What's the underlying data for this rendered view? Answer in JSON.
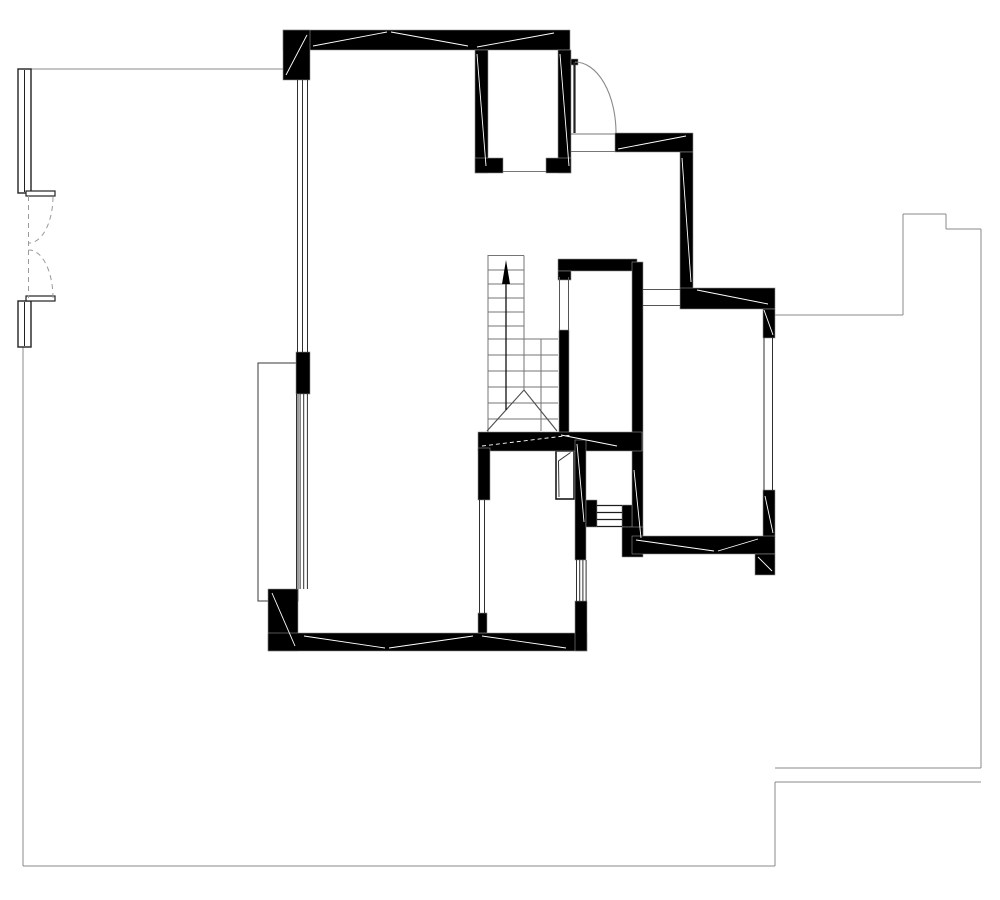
{
  "document": {
    "title": "architectural-floor-plan",
    "background": "#ffffff",
    "canvas": {
      "width": 1000,
      "height": 900
    }
  },
  "palette": {
    "wall": "#000000",
    "wall_halo": "#8f8f8f",
    "window_line": "#2f2f2f",
    "boundary": "#8a8a8a",
    "stair": "#757575",
    "break_line": "#4f4f4f",
    "arc": "#8a8a8a",
    "dash": "#9a9a9a",
    "hairline": "#ffffff",
    "arrow": "#000000"
  },
  "plan": {
    "walls": [
      {
        "name": "top-wall",
        "x": 283,
        "y": 30,
        "w": 287,
        "h": 20
      },
      {
        "name": "top-left-corner-pier",
        "x": 283,
        "y": 30,
        "w": 27,
        "h": 50
      },
      {
        "name": "left-wall-pier",
        "x": 296,
        "y": 352,
        "w": 14,
        "h": 42
      },
      {
        "name": "bottom-left-corner-pier",
        "x": 268,
        "y": 589,
        "w": 30,
        "h": 62
      },
      {
        "name": "bottom-wall",
        "x": 268,
        "y": 633,
        "w": 319,
        "h": 18
      },
      {
        "name": "shaft-left-wall",
        "x": 475,
        "y": 50,
        "w": 13,
        "h": 123
      },
      {
        "name": "shaft-right-wall",
        "x": 558,
        "y": 50,
        "w": 13,
        "h": 123
      },
      {
        "name": "shaft-bottom-wall-left",
        "x": 475,
        "y": 158,
        "w": 28,
        "h": 15
      },
      {
        "name": "shaft-bottom-wall-right",
        "x": 546,
        "y": 158,
        "w": 25,
        "h": 15
      },
      {
        "name": "entry-door-hinge-block",
        "x": 571,
        "y": 59,
        "w": 7,
        "h": 6
      },
      {
        "name": "entry-lintel-wall",
        "x": 615,
        "y": 133,
        "w": 78,
        "h": 19
      },
      {
        "name": "entry-side-wall",
        "x": 680,
        "y": 152,
        "w": 13,
        "h": 138
      },
      {
        "name": "hall-top-wall",
        "x": 558,
        "y": 259,
        "w": 79,
        "h": 12
      },
      {
        "name": "hall-top-wall-stub",
        "x": 558,
        "y": 271,
        "w": 13,
        "h": 9
      },
      {
        "name": "right-room-top-wall",
        "x": 680,
        "y": 288,
        "w": 95,
        "h": 21
      },
      {
        "name": "right-room-left-wall",
        "x": 632,
        "y": 262,
        "w": 11,
        "h": 292
      },
      {
        "name": "stair-side-wall",
        "x": 559,
        "y": 330,
        "w": 10,
        "h": 103
      },
      {
        "name": "understair-wall",
        "x": 478,
        "y": 432,
        "w": 164,
        "h": 19
      },
      {
        "name": "bath-right-wall",
        "x": 575,
        "y": 440,
        "w": 11,
        "h": 120
      },
      {
        "name": "bath-right-bottom-pier",
        "x": 575,
        "y": 601,
        "w": 12,
        "h": 50
      },
      {
        "name": "bath-left-wall",
        "x": 478,
        "y": 448,
        "w": 12,
        "h": 52
      },
      {
        "name": "bath-left-wall-stub",
        "x": 478,
        "y": 613,
        "w": 9,
        "h": 20
      },
      {
        "name": "louver-left-jamb",
        "x": 586,
        "y": 500,
        "w": 11,
        "h": 27
      },
      {
        "name": "louver-right-jamb",
        "x": 622,
        "y": 505,
        "w": 10,
        "h": 22
      },
      {
        "name": "right-room-corner-block",
        "x": 622,
        "y": 527,
        "w": 21,
        "h": 30
      },
      {
        "name": "right-room-right-wall-top",
        "x": 763,
        "y": 309,
        "w": 12,
        "h": 29
      },
      {
        "name": "right-room-right-wall-bottom",
        "x": 763,
        "y": 490,
        "w": 12,
        "h": 47
      },
      {
        "name": "right-room-bottom-wall",
        "x": 632,
        "y": 536,
        "w": 143,
        "h": 18
      },
      {
        "name": "right-room-bottom-stub",
        "x": 755,
        "y": 554,
        "w": 20,
        "h": 21
      }
    ],
    "boundary_lines": [
      [
        31,
        69,
        283,
        69
      ],
      [
        23,
        347,
        23,
        866
      ],
      [
        23,
        866,
        775,
        866
      ],
      [
        775,
        866,
        775,
        782
      ],
      [
        775,
        782,
        981,
        782
      ],
      [
        775,
        768,
        981,
        768
      ],
      [
        981,
        768,
        981,
        229
      ],
      [
        981,
        229,
        946,
        229
      ],
      [
        946,
        229,
        946,
        214
      ],
      [
        946,
        214,
        903,
        214
      ],
      [
        903,
        214,
        903,
        315
      ],
      [
        903,
        315,
        775,
        315
      ]
    ],
    "rects": [
      {
        "name": "planter-outline",
        "x": 258,
        "y": 363,
        "w": 40,
        "h": 238,
        "stroke": "#4a4a4a",
        "fill": "none",
        "sw": 1.1
      },
      {
        "name": "left-window-upper-box",
        "x": 18,
        "y": 69,
        "w": 13,
        "h": 124,
        "stroke": "#222222",
        "fill": "#ffffff",
        "sw": 1.4
      },
      {
        "name": "left-window-lower-box",
        "x": 18,
        "y": 301,
        "w": 13,
        "h": 46,
        "stroke": "#222222",
        "fill": "#ffffff",
        "sw": 1.4
      },
      {
        "name": "left-door-jamb-tick-upper",
        "x": 26,
        "y": 191,
        "w": 29,
        "h": 5,
        "stroke": "#222222",
        "fill": "#ffffff",
        "sw": 1.2
      },
      {
        "name": "left-door-jamb-tick-lower",
        "x": 26,
        "y": 296,
        "w": 29,
        "h": 5,
        "stroke": "#222222",
        "fill": "#ffffff",
        "sw": 1.2
      },
      {
        "name": "bath-door-frame",
        "x": 556,
        "y": 451,
        "w": 18,
        "h": 48,
        "stroke": "#1a1a1a",
        "fill": "#ffffff",
        "sw": 1.6
      }
    ],
    "line_groups": [
      {
        "name": "left-window-upper-mullion",
        "color": "#222222",
        "width": 1,
        "lines": [
          [
            24.5,
            70,
            24.5,
            192
          ]
        ]
      },
      {
        "name": "left-window-lower-mullion",
        "color": "#222222",
        "width": 1,
        "lines": [
          [
            24.5,
            302,
            24.5,
            346
          ]
        ]
      },
      {
        "name": "main-room-upper-window",
        "color": "#2f2f2f",
        "width": 1,
        "lines": [
          [
            297.5,
            80,
            297.5,
            352
          ],
          [
            302.5,
            80,
            302.5,
            352
          ],
          [
            307.5,
            80,
            307.5,
            352
          ]
        ]
      },
      {
        "name": "main-room-lower-window",
        "color": "#2f2f2f",
        "width": 1,
        "lines": [
          [
            296.5,
            394,
            296.5,
            589
          ],
          [
            300.1,
            394,
            300.1,
            589
          ],
          [
            303.7,
            394,
            303.7,
            589
          ],
          [
            307.4,
            394,
            307.4,
            589
          ]
        ]
      },
      {
        "name": "bath-left-window",
        "color": "#2f2f2f",
        "width": 1,
        "lines": [
          [
            479.5,
            500,
            479.5,
            613
          ],
          [
            484.5,
            500,
            484.5,
            613
          ]
        ]
      },
      {
        "name": "bath-right-window",
        "color": "#2f2f2f",
        "width": 1,
        "lines": [
          [
            576.5,
            560,
            576.5,
            601
          ],
          [
            579.7,
            560,
            579.7,
            601
          ],
          [
            582.9,
            560,
            582.9,
            601
          ],
          [
            586.1,
            560,
            586.1,
            601
          ]
        ]
      },
      {
        "name": "right-room-window",
        "color": "#2f2f2f",
        "width": 1,
        "lines": [
          [
            764,
            338,
            764,
            490
          ],
          [
            772.5,
            338,
            772.5,
            490
          ]
        ]
      },
      {
        "name": "stair-opening-edges",
        "color": "#555555",
        "width": 1,
        "lines": [
          [
            559.5,
            277,
            559.5,
            330
          ],
          [
            568.5,
            277,
            568.5,
            330
          ]
        ]
      },
      {
        "name": "hall-opening-edges",
        "color": "#555555",
        "width": 1,
        "lines": [
          [
            643,
            289.5,
            680,
            289.5
          ],
          [
            643,
            305.5,
            680,
            305.5
          ]
        ]
      },
      {
        "name": "entry-threshold",
        "color": "#777777",
        "width": 1,
        "lines": [
          [
            571,
            134,
            615,
            134
          ],
          [
            571,
            151.5,
            615,
            151.5
          ]
        ]
      },
      {
        "name": "shaft-vent-edge",
        "color": "#777777",
        "width": 1,
        "lines": [
          [
            503,
            171.5,
            546,
            171.5
          ]
        ]
      },
      {
        "name": "louver-slats",
        "color": "#1d1d1d",
        "width": 1.2,
        "lines": [
          [
            597,
            505.5,
            622,
            505.5
          ],
          [
            597,
            512.5,
            622,
            512.5
          ],
          [
            597,
            519.5,
            622,
            519.5
          ],
          [
            597,
            526.5,
            622,
            526.5
          ]
        ]
      },
      {
        "name": "stair-outline",
        "color": "#757575",
        "width": 1,
        "lines": [
          [
            488,
            255,
            488,
            432
          ],
          [
            488,
            255.5,
            524,
            255.5
          ],
          [
            524,
            255.5,
            524,
            390
          ],
          [
            541,
            339,
            541,
            431
          ]
        ]
      },
      {
        "name": "stair-treads-upper-flight",
        "color": "#757575",
        "width": 1,
        "lines": [
          [
            488,
            270,
            524,
            270
          ],
          [
            488,
            284,
            524,
            284
          ],
          [
            488,
            298,
            524,
            298
          ],
          [
            488,
            312,
            524,
            312
          ],
          [
            488,
            326,
            524,
            326
          ]
        ]
      },
      {
        "name": "stair-treads-lower-flight",
        "color": "#757575",
        "width": 1,
        "lines": [
          [
            488,
            339,
            558,
            339
          ],
          [
            488,
            355,
            558,
            355
          ],
          [
            488,
            371,
            558,
            371
          ],
          [
            488,
            387,
            558,
            387
          ],
          [
            488,
            403,
            558,
            403
          ],
          [
            488,
            419,
            558,
            419
          ]
        ]
      },
      {
        "name": "stair-break-lines",
        "color": "#4f4f4f",
        "width": 1.1,
        "lines": [
          [
            487,
            431,
            524,
            390
          ],
          [
            524,
            390,
            557,
            431
          ]
        ]
      },
      {
        "name": "stair-direction-stem",
        "color": "#111111",
        "width": 1.3,
        "lines": [
          [
            506,
            268,
            506,
            410
          ]
        ]
      },
      {
        "name": "entry-door-leaf",
        "color": "#222222",
        "width": 2.2,
        "lines": [
          [
            574.5,
            62,
            574.5,
            133
          ]
        ]
      }
    ],
    "hairlines": [
      [
        286,
        75,
        307,
        35
      ],
      [
        313,
        46,
        387,
        32
      ],
      [
        391,
        32,
        468,
        46
      ],
      [
        477,
        47,
        554,
        33
      ],
      [
        618,
        149,
        686,
        136
      ],
      [
        682,
        158,
        691,
        282
      ],
      [
        697,
        290,
        768,
        304
      ],
      [
        272,
        593,
        295,
        646
      ],
      [
        304,
        636,
        385,
        648
      ],
      [
        389,
        648,
        473,
        636
      ],
      [
        482,
        636,
        566,
        648
      ],
      [
        636,
        540,
        714,
        551
      ],
      [
        718,
        551,
        758,
        539
      ],
      [
        758,
        557,
        772,
        571
      ],
      [
        561,
        435,
        617,
        446
      ],
      [
        634,
        470,
        641,
        538
      ],
      [
        577,
        444,
        584,
        522
      ],
      [
        764,
        310,
        773,
        335
      ],
      [
        765,
        496,
        773,
        533
      ],
      [
        477,
        54,
        486,
        166
      ],
      [
        560,
        54,
        569,
        166
      ]
    ],
    "dashed_hairlines": [
      [
        482,
        446,
        572,
        435
      ]
    ],
    "dashed_lines": [
      {
        "name": "left-double-door-closed-line",
        "line": [
          28.5,
          196,
          28.5,
          298
        ]
      }
    ],
    "paths": [
      {
        "name": "entry-door-swing-arc",
        "d": "M 575 62 A 41 71 0 0 1 616 133",
        "color": "#8a8a8a",
        "width": 1.1,
        "dash": ""
      },
      {
        "name": "left-double-door-swing-upper",
        "d": "M 53 197 A 24 47 0 0 1 28.5 243",
        "color": "#9a9a9a",
        "width": 1,
        "dash": "5 4"
      },
      {
        "name": "left-double-door-swing-lower",
        "d": "M 53 298 A 24 48 0 0 0 28.5 250",
        "color": "#9a9a9a",
        "width": 1,
        "dash": "5 4"
      },
      {
        "name": "bath-door-leaf",
        "d": "M 559 497 L 558.5 461 L 570.5 452.5",
        "color": "#333333",
        "width": 1,
        "dash": ""
      }
    ],
    "polygons": [
      {
        "name": "stair-direction-arrowhead",
        "points": "506,260 502,284 510,284",
        "fill": "#000000"
      }
    ]
  }
}
